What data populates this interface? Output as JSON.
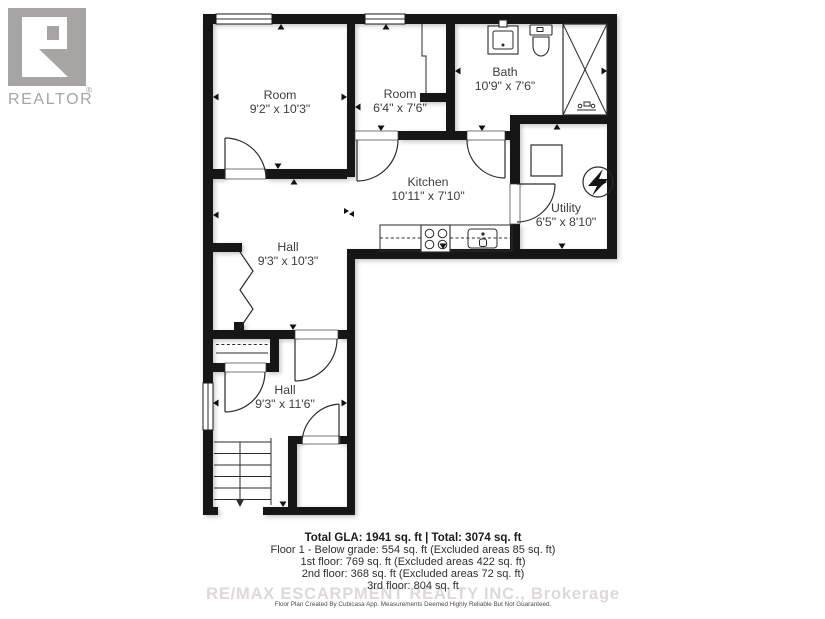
{
  "branding": {
    "logo_label": "REALTOR",
    "registered_mark": "®"
  },
  "rooms": [
    {
      "name": "Room",
      "dims": "9'2\" x 10'3\""
    },
    {
      "name": "Room",
      "dims": "6'4\" x 7'6\""
    },
    {
      "name": "Bath",
      "dims": "10'9\" x 7'6\""
    },
    {
      "name": "Kitchen",
      "dims": "10'11\" x 7'10\""
    },
    {
      "name": "Utility",
      "dims": "6'5\" x 8'10\""
    },
    {
      "name": "Hall",
      "dims": "9'3\" x 10'3\""
    },
    {
      "name": "Hall",
      "dims": "9'3\" x 11'6\""
    }
  ],
  "fixtures": [
    "bathroom-sink",
    "toilet",
    "shower",
    "washer",
    "electrical-meter",
    "kitchen-counter",
    "stove",
    "kitchen-sink",
    "staircase-down",
    "bifold-closet-doors",
    "closet-shelf"
  ],
  "summary": {
    "total_line": "Total GLA: 1941 sq. ft | Total: 3074 sq. ft",
    "floor_lines": [
      "Floor 1 - Below grade: 554 sq. ft (Excluded areas 85 sq. ft)",
      "1st floor: 769 sq. ft (Excluded areas 422 sq. ft)",
      "2nd floor: 368 sq. ft (Excluded areas 72 sq. ft)",
      "3rd floor: 804 sq. ft"
    ],
    "disclaimer": "Floor Plan Created By Cubicasa App. Measurements Deemed Highly Reliable But Not Guaranteed."
  },
  "watermark": "RE/MAX ESCARPMENT REALTY INC., Brokerage",
  "colors": {
    "wall": "#161616",
    "label_text": "#3d3d3d",
    "logo_gray": "#a7a4a4",
    "watermark_gray": "#dcd9d7",
    "summary_text": "#2e2e2e"
  }
}
